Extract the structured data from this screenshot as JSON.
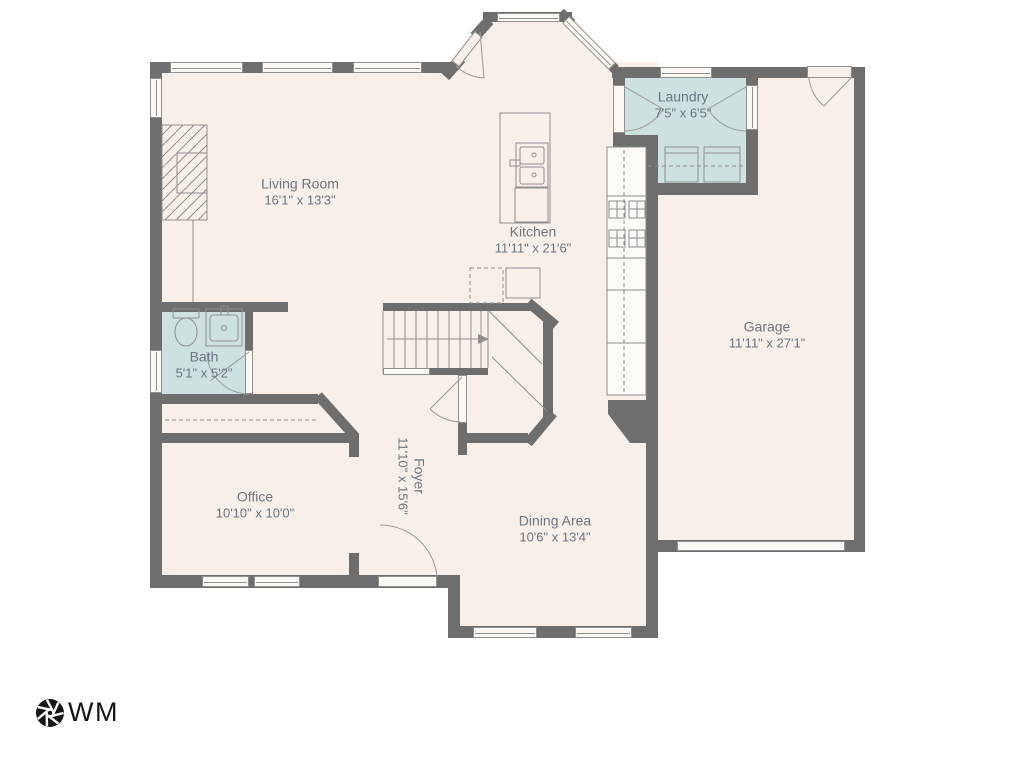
{
  "rooms": {
    "living": {
      "name": "Living Room",
      "dims": "16'1\" x 13'3\""
    },
    "kitchen": {
      "name": "Kitchen",
      "dims": "11'11\" x 21'6\""
    },
    "laundry": {
      "name": "Laundry",
      "dims": "7'5\" x 6'5\""
    },
    "garage": {
      "name": "Garage",
      "dims": "11'11\" x 27'1\""
    },
    "bath": {
      "name": "Bath",
      "dims": "5'1\" x 5'2\""
    },
    "office": {
      "name": "Office",
      "dims": "10'10\" x 10'0\""
    },
    "foyer": {
      "name": "Foyer",
      "dims": "11'10\" x 15'6\""
    },
    "dining": {
      "name": "Dining Area",
      "dims": "10'6\" x 13'4\""
    }
  },
  "logo": {
    "text": "WM",
    "icon": "aperture-icon"
  },
  "colors": {
    "background": "#ffffff",
    "floor": "#f8efe8",
    "wet_room": "#cee1e1",
    "wall": "#6e6e6e",
    "outline": "#8f8f8f",
    "label_text": "#6b7681",
    "logo": "#161616"
  }
}
